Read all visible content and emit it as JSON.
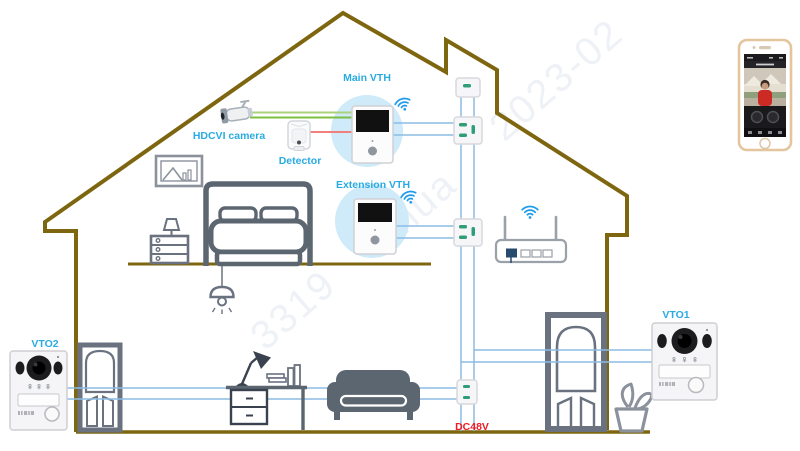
{
  "diagram": {
    "labels": {
      "main_vth": "Main VTH",
      "extension_vth": "Extension VTH",
      "hdcvi_camera": "HDCVI camera",
      "detector": "Detector",
      "vto1": "VTO1",
      "vto2": "VTO2",
      "power": "DC48V"
    },
    "watermark": {
      "fragments": [
        "3319",
        "hua",
        "2023-02"
      ]
    },
    "colors": {
      "label": "#29ABE2",
      "power_label": "#ED1C24",
      "house": "#7D660F",
      "wire": "#8CBCE4",
      "camera_wire": "#7CBF41",
      "camera_wire_light": "#AAD27A",
      "detector_wire": "#F0807E",
      "wifi": "#1E9BE9",
      "furniture": "#5B6670",
      "device_halo": "#CFEAF9",
      "junction_led": "#2F9E77"
    }
  }
}
